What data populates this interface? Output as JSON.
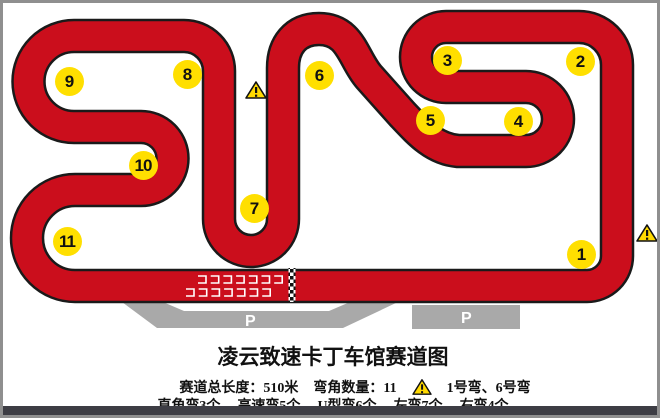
{
  "title": "凌云致速卡丁车馆赛道图",
  "map": {
    "corner_labels": [
      "1",
      "2",
      "3",
      "4",
      "5",
      "6",
      "7",
      "8",
      "9",
      "10",
      "11"
    ],
    "parking_label": "P",
    "warning_icon_glyph": "!",
    "colors": {
      "track_red": "#cb0e1c",
      "track_outline": "#1a1a1a",
      "badge_yellow": "#ffdf00",
      "warning_yellow": "#ffd900",
      "parking_gray": "#a9a9a9",
      "frame_gray": "#8f8f8f",
      "bottom_bar_dark": "#3d3d44"
    }
  },
  "stats": {
    "length": "赛道总长度：510米",
    "corner_count": "弯角数量：11",
    "warning_note": "1号弯、6号弯",
    "corner_types": [
      "直角弯3个",
      "高速弯5个",
      "U型弯6个",
      "左弯7个",
      "右弯4个"
    ]
  }
}
